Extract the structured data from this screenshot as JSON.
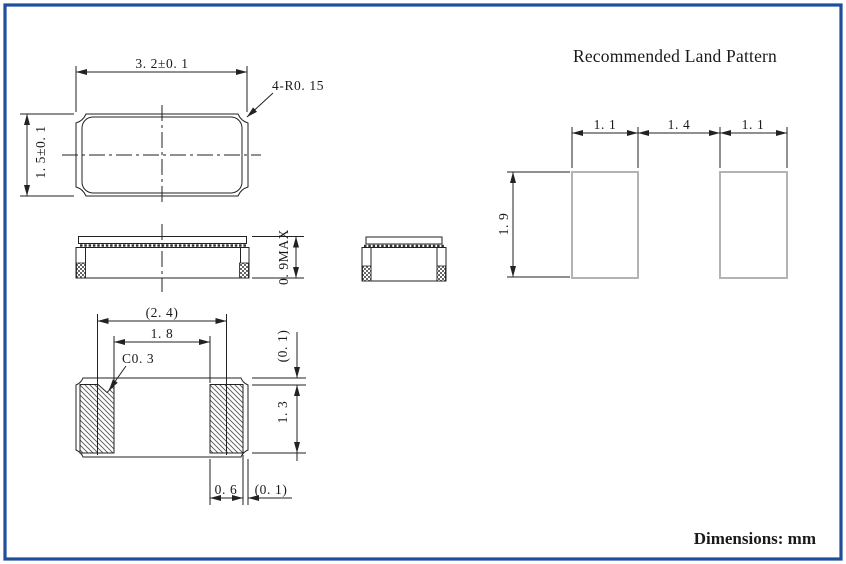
{
  "page": {
    "units_note": "Dimensions: mm",
    "frame_color": "#1f4e9c"
  },
  "colors": {
    "line": "#222222",
    "hatch": "#555555",
    "land_outline": "#b3b3b3"
  },
  "package_drawing": {
    "top_view": {
      "width": "3. 2±0. 1",
      "height": "1. 5±0. 1",
      "corner_radius": "4-R0. 15"
    },
    "side_view": {
      "max_height": "0. 9MAX"
    },
    "bottom_view": {
      "pad_center_pitch": "(2. 4)",
      "pad_inner_gap": "1. 8",
      "chamfer": "C0. 3",
      "top_margin": "(0. 1)",
      "pad_depth": "1. 3",
      "pad_width": "0. 6",
      "side_margin": "(0. 1)"
    }
  },
  "land_pattern": {
    "title": "Recommended Land Pattern",
    "left_pad_width": "1. 1",
    "pad_gap": "1. 4",
    "right_pad_width": "1. 1",
    "pad_height": "1. 9"
  }
}
